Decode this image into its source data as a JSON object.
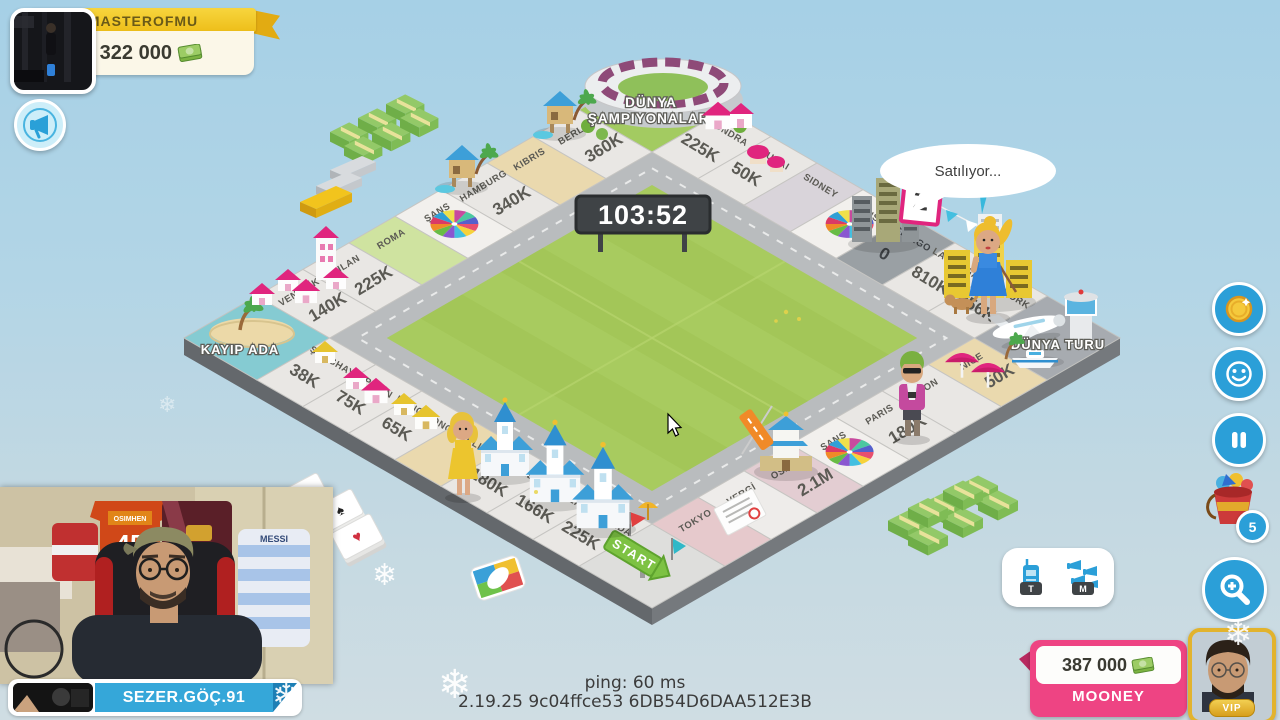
{
  "hud": {
    "top_player": {
      "name": "MASTEROFMU",
      "money": "1 322 000",
      "cash_icon": "green-cash-stack",
      "avatar": "gym-photo"
    },
    "announce_button": {
      "icon": "megaphone"
    },
    "right_toolbar": {
      "coin_button": {
        "icon": "gold-coin"
      },
      "emote_button": {
        "icon": "smiley-face"
      },
      "pause_button": {
        "icon": "pause"
      },
      "toys_button": {
        "icon": "toy-bucket",
        "badge": "5"
      },
      "zoom_button": {
        "icon": "magnifier-plus"
      }
    },
    "voice_buttons": {
      "talk": {
        "icon": "walkie-talkie",
        "label": "T"
      },
      "mute": {
        "icon": "megaphones",
        "label": "M"
      }
    },
    "bottom_player": {
      "name": "MOONEY",
      "money": "387 000",
      "vip_label": "VIP",
      "cash_icon": "green-cash-stack"
    },
    "status_bar": {
      "ping": "ping: 60 ms",
      "version": "2.19.25 9c04ffce53 6DB54D6DAA512E3B"
    }
  },
  "stream": {
    "streamer_name": "SEZER.GÖÇ.91",
    "webcam_jerseys": [
      "OSIMHEN",
      "45",
      "MESSI"
    ]
  },
  "game": {
    "timer": "103:52",
    "speech_bubble": "Satılıyor...",
    "auction_card": "2",
    "board": {
      "corners": {
        "top": {
          "name": "DÜNYA ŞAMPIYONALARI",
          "lines": [
            "DÜNYA",
            "ŞAMPIYONALARI"
          ]
        },
        "left": {
          "name": "KAYIP ADA"
        },
        "bottom": {
          "name": "START"
        },
        "right": {
          "name": "DÜNYA TURU"
        }
      },
      "top_left": [
        {
          "name": "BERLIN",
          "price": "360K",
          "color": "#e9e7e4"
        },
        {
          "name": "KIBRIS",
          "price": "",
          "color": "#ead9ae"
        },
        {
          "name": "HAMBURG",
          "price": "340K",
          "color": "#e9e7e4"
        },
        {
          "name": "ŞANS",
          "price": "",
          "color": "#f2f0ed",
          "wheel": true
        },
        {
          "name": "ROMA",
          "price": "",
          "color": "#cfe3a0"
        },
        {
          "name": "MILAN",
          "price": "225K",
          "color": "#e9e7e4"
        },
        {
          "name": "VENEDİK",
          "price": "140K",
          "color": "#e9e7e4"
        }
      ],
      "top_right": [
        {
          "name": "LONDRA",
          "price": "225K",
          "color": "#e9e7e4"
        },
        {
          "name": "DUBAI",
          "price": "50K",
          "color": "#e9e7e4"
        },
        {
          "name": "SIDNEY",
          "price": "",
          "color": "#d9d4da"
        },
        {
          "name": "ŞANS",
          "price": "",
          "color": "#f2f0ed",
          "wheel": true
        },
        {
          "name": "ŞİKAGO",
          "price": "0",
          "color": "#9aa0a4"
        },
        {
          "name": "LAS VEGAS",
          "price": "810K",
          "color": "#e9e7e4"
        },
        {
          "name": "NEW YORK",
          "price": "856K",
          "color": "#e9e7e4"
        }
      ],
      "bottom_left": [
        {
          "name": "ŞANGHAY",
          "price": "38K",
          "color": "#e9e7e4"
        },
        {
          "name": "PEKİN",
          "price": "75K",
          "color": "#e9e7e4"
        },
        {
          "name": "HONG KONG",
          "price": "65K",
          "color": "#e9e7e4"
        },
        {
          "name": "BALI",
          "price": "",
          "color": "#ead9ae"
        },
        {
          "name": "MADRID",
          "price": "180K",
          "color": "#e9e7e4"
        },
        {
          "name": "SEVILLA",
          "price": "166K",
          "color": "#e9e7e4"
        },
        {
          "name": "GRANADA",
          "price": "225K",
          "color": "#e9e7e4"
        }
      ],
      "bottom_right": [
        {
          "name": "NICE",
          "price": "50K",
          "color": "#ead9ae"
        },
        {
          "name": "LYON",
          "price": "",
          "color": "#e9e7e4"
        },
        {
          "name": "PARIS",
          "price": "180K",
          "color": "#e9e7e4"
        },
        {
          "name": "ŞANS",
          "price": "",
          "color": "#f2f0ed",
          "wheel": true
        },
        {
          "name": "OSAKA",
          "price": "2.1M",
          "color": "#e3cdd2"
        },
        {
          "name": "VERGİ",
          "price": "",
          "color": "#eeecea"
        },
        {
          "name": "TOKYO",
          "price": "",
          "color": "#e6c9cc"
        }
      ]
    }
  },
  "theme": {
    "sky": "#aed3e7",
    "field_green": "#a8cb5f",
    "road_gray": "#b9bcbe",
    "tile_light": "#e9e7e4",
    "sand": "#ead9ae",
    "gold_banner": "#f2c41d",
    "pink_banner": "#ee4483",
    "blue_banner": "#35a7d9",
    "hud_blue": "#2b9fd8",
    "auction_tile_gray": "#9aa0a4",
    "money_green": "#8bc34a"
  }
}
